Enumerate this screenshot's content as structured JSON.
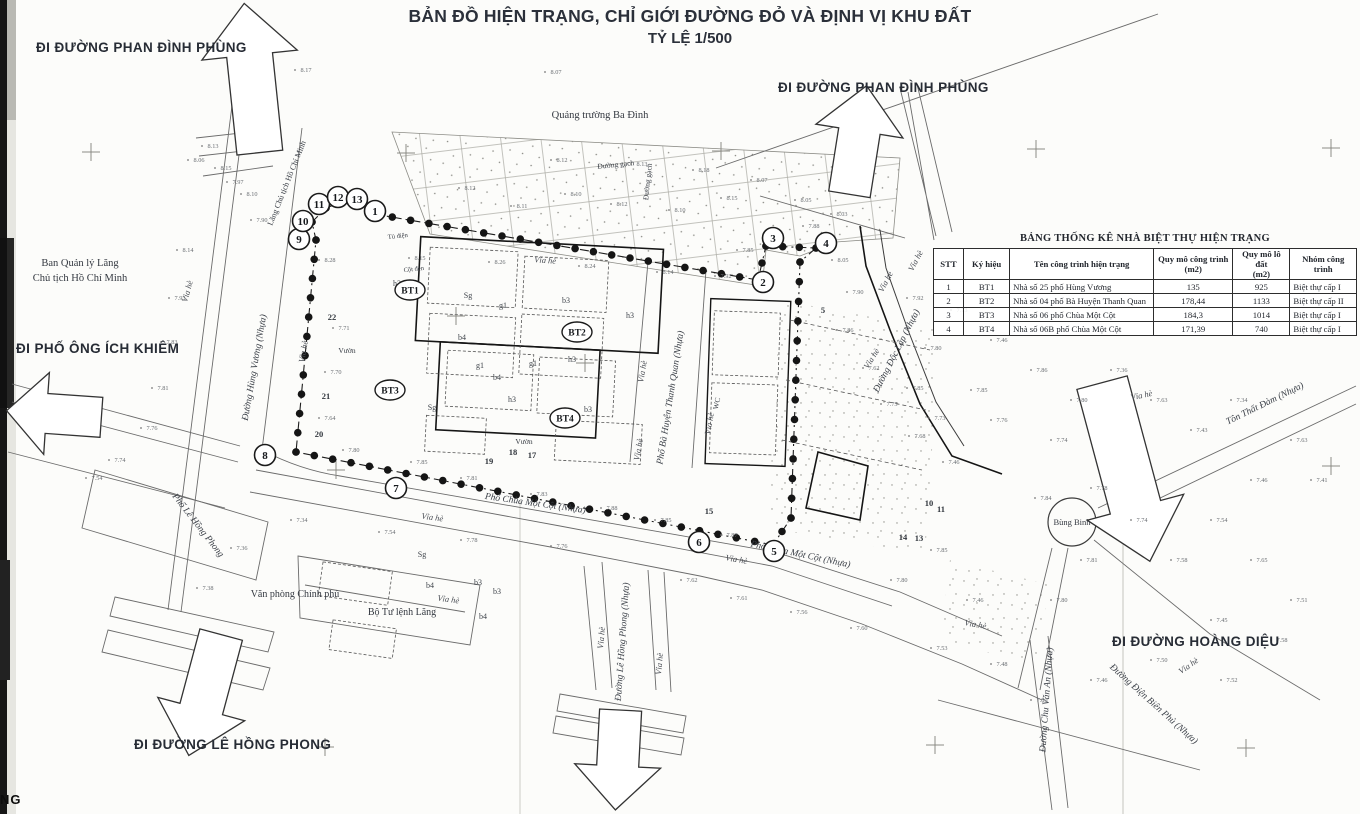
{
  "title": {
    "line1": "BẢN ĐỒ HIỆN TRẠNG, CHỈ GIỚI ĐƯỜNG ĐỎ VÀ ĐỊNH VỊ KHU ĐẤT",
    "line2": "TỶ LỆ 1/500"
  },
  "direction_labels": [
    {
      "text": "ĐI ĐƯỜNG PHAN ĐÌNH PHÙNG",
      "x": 36,
      "y": 40
    },
    {
      "text": "ĐI ĐƯỜNG PHAN ĐÌNH PHÙNG",
      "x": 778,
      "y": 80
    },
    {
      "text": "ĐI PHỐ ÔNG ÍCH KHIÊM",
      "x": 16,
      "y": 341
    },
    {
      "text": "ĐI ĐƯỜNG LÊ HỒNG PHONG",
      "x": 134,
      "y": 737
    },
    {
      "text": "ĐI ĐƯỜNG HOÀNG DIỆU",
      "x": 1112,
      "y": 634
    }
  ],
  "table": {
    "title": "BẢNG THỐNG KÊ NHÀ BIỆT THỰ HIỆN TRẠNG",
    "headers": [
      "STT",
      "Ký hiệu",
      "Tên công trình hiện trạng",
      "Quy mô công trình\n(m2)",
      "Quy mô lô đất\n(m2)",
      "Nhóm công trình"
    ],
    "col_widths": [
      26,
      44,
      152,
      80,
      56,
      66
    ],
    "rows": [
      [
        "1",
        "BT1",
        "Nhà số 25 phố Hùng Vương",
        "135",
        "925",
        "Biệt thự cấp I"
      ],
      [
        "2",
        "BT2",
        "Nhà số 04 phố Bà Huyện Thanh Quan",
        "178,44",
        "1133",
        "Biệt thự cấp II"
      ],
      [
        "3",
        "BT3",
        "Nhà số 06 phố Chùa Một Cột",
        "184,3",
        "1014",
        "Biệt thự cấp I"
      ],
      [
        "4",
        "BT4",
        "Nhà số 06B phố Chùa Một Cột",
        "171,39",
        "740",
        "Biệt thự cấp I"
      ]
    ]
  },
  "map": {
    "place_labels": [
      {
        "text": "Quảng trường Ba Đình",
        "x": 600,
        "y": 118,
        "size": 10.5
      },
      {
        "text": "Ban Quản lý Lăng",
        "x": 80,
        "y": 266,
        "size": 10.5
      },
      {
        "text": "Chủ tịch Hồ Chí Minh",
        "x": 80,
        "y": 281,
        "size": 10.5
      },
      {
        "text": "Lăng Chủ tịch Hồ Chí Minh",
        "x": 289,
        "y": 184,
        "rot": -68,
        "size": 8
      },
      {
        "text": "Văn phòng Chính phủ",
        "x": 295,
        "y": 597,
        "size": 10
      },
      {
        "text": "Bộ Tư lệnh Lăng",
        "x": 402,
        "y": 615,
        "size": 10
      },
      {
        "text": "Bùng Binh",
        "x": 1072,
        "y": 525,
        "size": 8.5
      },
      {
        "text": "Đường gạch",
        "x": 616,
        "y": 167,
        "rot": -6,
        "size": 7.5
      },
      {
        "text": "Đường gạch",
        "x": 650,
        "y": 182,
        "rot": -84,
        "size": 7.5
      },
      {
        "text": "Vườn",
        "x": 347,
        "y": 353,
        "size": 7.5
      },
      {
        "text": "Vườn",
        "x": 524,
        "y": 444,
        "size": 7.5
      },
      {
        "text": "WC",
        "x": 719,
        "y": 404,
        "rot": -78,
        "size": 7.5
      },
      {
        "text": "Cột đèn",
        "x": 414,
        "y": 271,
        "rot": -6,
        "size": 6.5
      },
      {
        "text": "Tủ điện",
        "x": 398,
        "y": 238,
        "rot": -6,
        "size": 6.5
      }
    ],
    "street_labels": [
      {
        "text": "Đường Hùng Vương (Nhựa)",
        "x": 257,
        "y": 368,
        "rot": -80
      },
      {
        "text": "Phố Bà Huyện Thanh Quan (Nhựa)",
        "x": 673,
        "y": 398,
        "rot": -81
      },
      {
        "text": "Phố Chùa Một Cột (Nhựa)",
        "x": 535,
        "y": 506,
        "rot": 8
      },
      {
        "text": "Phố Chùa Một Cột (Nhựa)",
        "x": 800,
        "y": 557,
        "rot": 12
      },
      {
        "text": "Phố Lê Hồng Phong",
        "x": 196,
        "y": 527,
        "rot": 52
      },
      {
        "text": "Đường Lê Hồng Phong (Nhựa)",
        "x": 625,
        "y": 642,
        "rot": -86
      },
      {
        "text": "Đường Độc Lập (Nhựa)",
        "x": 899,
        "y": 352,
        "rot": -63
      },
      {
        "text": "Tôn Thất Đàm (Nhựa)",
        "x": 1266,
        "y": 406,
        "rot": -26
      },
      {
        "text": "Đường Chu Văn An (Nhựa)",
        "x": 1049,
        "y": 700,
        "rot": -86
      },
      {
        "text": "Đường Điện Biên Phủ (Nhựa)",
        "x": 1152,
        "y": 706,
        "rot": 42
      }
    ],
    "via_he": {
      "text": "Vỉa hè",
      "positions": [
        [
          190,
          292,
          -75
        ],
        [
          306,
          352,
          -80
        ],
        [
          545,
          263,
          4
        ],
        [
          645,
          372,
          -80
        ],
        [
          712,
          424,
          -80
        ],
        [
          641,
          450,
          -80
        ],
        [
          432,
          520,
          8
        ],
        [
          736,
          562,
          10
        ],
        [
          448,
          602,
          8
        ],
        [
          604,
          638,
          -85
        ],
        [
          662,
          664,
          -85
        ],
        [
          888,
          283,
          -62
        ],
        [
          874,
          360,
          -58
        ],
        [
          918,
          262,
          -62
        ],
        [
          1142,
          398,
          -12
        ],
        [
          1190,
          668,
          -35
        ],
        [
          975,
          627,
          10
        ]
      ]
    },
    "boundary_points": [
      {
        "n": "1",
        "x": 375,
        "y": 211
      },
      {
        "n": "2",
        "x": 763,
        "y": 282
      },
      {
        "n": "3",
        "x": 773,
        "y": 238
      },
      {
        "n": "4",
        "x": 826,
        "y": 243
      },
      {
        "n": "5",
        "x": 774,
        "y": 551
      },
      {
        "n": "6",
        "x": 699,
        "y": 542
      },
      {
        "n": "7",
        "x": 396,
        "y": 488
      },
      {
        "n": "8",
        "x": 265,
        "y": 455
      },
      {
        "n": "9",
        "x": 299,
        "y": 239
      },
      {
        "n": "10",
        "x": 303,
        "y": 221
      },
      {
        "n": "11",
        "x": 319,
        "y": 204
      },
      {
        "n": "12",
        "x": 338,
        "y": 197
      },
      {
        "n": "13",
        "x": 357,
        "y": 199
      }
    ],
    "bt_markers": [
      {
        "label": "BT1",
        "x": 410,
        "y": 290
      },
      {
        "label": "BT2",
        "x": 577,
        "y": 332
      },
      {
        "label": "BT3",
        "x": 390,
        "y": 390
      },
      {
        "label": "BT4",
        "x": 565,
        "y": 418
      }
    ],
    "lot_numbers": [
      [
        332,
        320,
        "22"
      ],
      [
        326,
        399,
        "21"
      ],
      [
        319,
        437,
        "20"
      ],
      [
        489,
        464,
        "19"
      ],
      [
        513,
        455,
        "18"
      ],
      [
        532,
        458,
        "17"
      ],
      [
        709,
        514,
        "15"
      ],
      [
        903,
        540,
        "14"
      ],
      [
        919,
        541,
        "13"
      ],
      [
        929,
        506,
        "10"
      ],
      [
        941,
        512,
        "11"
      ],
      [
        823,
        313,
        "5"
      ]
    ],
    "block_codes": [
      [
        397,
        286,
        "h3"
      ],
      [
        468,
        298,
        "Sg"
      ],
      [
        503,
        308,
        "g1"
      ],
      [
        566,
        303,
        "b3"
      ],
      [
        630,
        318,
        "h3"
      ],
      [
        462,
        340,
        "b4"
      ],
      [
        480,
        368,
        "g1"
      ],
      [
        432,
        410,
        "Sg"
      ],
      [
        497,
        380,
        "b4"
      ],
      [
        572,
        362,
        "h3"
      ],
      [
        533,
        366,
        "g1"
      ],
      [
        588,
        412,
        "b3"
      ],
      [
        512,
        402,
        "h3"
      ],
      [
        422,
        557,
        "Sg"
      ],
      [
        478,
        585,
        "b3"
      ],
      [
        497,
        594,
        "b3"
      ],
      [
        430,
        588,
        "b4"
      ],
      [
        483,
        619,
        "b4"
      ]
    ],
    "spot_elevations": [
      [
        556,
        74,
        "8.07"
      ],
      [
        306,
        72,
        "8.17"
      ],
      [
        213,
        148,
        "8.13"
      ],
      [
        199,
        162,
        "8.06"
      ],
      [
        226,
        170,
        "8.15"
      ],
      [
        238,
        184,
        "7.97"
      ],
      [
        252,
        196,
        "8.10"
      ],
      [
        188,
        252,
        "8.14"
      ],
      [
        180,
        300,
        "7.93"
      ],
      [
        172,
        344,
        "7.83"
      ],
      [
        163,
        390,
        "7.81"
      ],
      [
        152,
        430,
        "7.76"
      ],
      [
        120,
        462,
        "7.74"
      ],
      [
        97,
        480,
        "7.54"
      ],
      [
        262,
        222,
        "7.90"
      ],
      [
        330,
        262,
        "8.28"
      ],
      [
        420,
        260,
        "8.15"
      ],
      [
        500,
        264,
        "8.26"
      ],
      [
        590,
        268,
        "8.24"
      ],
      [
        668,
        274,
        "8.14"
      ],
      [
        726,
        278,
        "7.92"
      ],
      [
        748,
        252,
        "7.85"
      ],
      [
        470,
        190,
        "8.12"
      ],
      [
        522,
        208,
        "8.11"
      ],
      [
        576,
        196,
        "8.10"
      ],
      [
        622,
        206,
        "8.12"
      ],
      [
        680,
        212,
        "8.10"
      ],
      [
        732,
        200,
        "8.15"
      ],
      [
        642,
        166,
        "8.13"
      ],
      [
        562,
        162,
        "8.12"
      ],
      [
        704,
        172,
        "8.18"
      ],
      [
        762,
        182,
        "8.07"
      ],
      [
        806,
        202,
        "8.05"
      ],
      [
        842,
        216,
        "8.03"
      ],
      [
        814,
        228,
        "7.88"
      ],
      [
        843,
        262,
        "8.05"
      ],
      [
        858,
        294,
        "7.90"
      ],
      [
        848,
        332,
        "7.86"
      ],
      [
        874,
        370,
        "7.62"
      ],
      [
        892,
        406,
        "7.75"
      ],
      [
        920,
        438,
        "7.68"
      ],
      [
        954,
        464,
        "7.46"
      ],
      [
        344,
        330,
        "7.71"
      ],
      [
        336,
        374,
        "7.70"
      ],
      [
        330,
        420,
        "7.64"
      ],
      [
        354,
        452,
        "7.80"
      ],
      [
        422,
        464,
        "7.85"
      ],
      [
        472,
        480,
        "7.81"
      ],
      [
        542,
        496,
        "7.83"
      ],
      [
        612,
        510,
        "7.88"
      ],
      [
        666,
        522,
        "7.85"
      ],
      [
        732,
        537,
        "7.87"
      ],
      [
        562,
        548,
        "7.76"
      ],
      [
        472,
        542,
        "7.78"
      ],
      [
        390,
        534,
        "7.54"
      ],
      [
        302,
        522,
        "7.34"
      ],
      [
        242,
        550,
        "7.36"
      ],
      [
        208,
        590,
        "7.38"
      ],
      [
        692,
        582,
        "7.62"
      ],
      [
        742,
        600,
        "7.61"
      ],
      [
        802,
        614,
        "7.56"
      ],
      [
        862,
        630,
        "7.60"
      ],
      [
        942,
        650,
        "7.53"
      ],
      [
        1002,
        666,
        "7.48"
      ],
      [
        1062,
        602,
        "7.80"
      ],
      [
        1092,
        562,
        "7.81"
      ],
      [
        1046,
        500,
        "7.84"
      ],
      [
        1102,
        490,
        "7.78"
      ],
      [
        1142,
        522,
        "7.74"
      ],
      [
        1182,
        562,
        "7.58"
      ],
      [
        1222,
        522,
        "7.54"
      ],
      [
        1262,
        482,
        "7.46"
      ],
      [
        1302,
        442,
        "7.63"
      ],
      [
        1322,
        482,
        "7.41"
      ],
      [
        1262,
        562,
        "7.65"
      ],
      [
        1302,
        602,
        "7.51"
      ],
      [
        1222,
        622,
        "7.45"
      ],
      [
        1162,
        662,
        "7.50"
      ],
      [
        1102,
        682,
        "7.46"
      ],
      [
        1042,
        702,
        "7.80"
      ],
      [
        1232,
        682,
        "7.52"
      ],
      [
        1282,
        642,
        "7.58"
      ],
      [
        962,
        312,
        "7.73"
      ],
      [
        1002,
        342,
        "7.46"
      ],
      [
        1042,
        372,
        "7.86"
      ],
      [
        1082,
        402,
        "7.80"
      ],
      [
        1122,
        372,
        "7.36"
      ],
      [
        1162,
        402,
        "7.63"
      ],
      [
        1202,
        432,
        "7.43"
      ],
      [
        1242,
        402,
        "7.34"
      ],
      [
        1002,
        422,
        "7.76"
      ],
      [
        982,
        392,
        "7.85"
      ],
      [
        1062,
        442,
        "7.74"
      ],
      [
        942,
        552,
        "7.85"
      ],
      [
        902,
        582,
        "7.80"
      ],
      [
        978,
        602,
        "7.46"
      ],
      [
        918,
        300,
        "7.92"
      ],
      [
        936,
        350,
        "7.80"
      ],
      [
        918,
        390,
        "7.85"
      ],
      [
        940,
        420,
        "7.73"
      ]
    ],
    "corner_fragment": "NG"
  }
}
